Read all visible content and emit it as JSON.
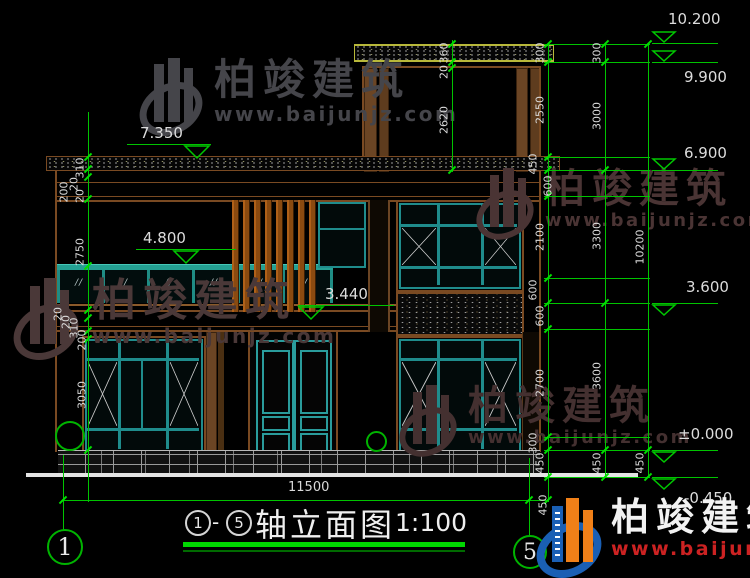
{
  "drawing": {
    "title": {
      "axis_start": "1",
      "dash": "-",
      "axis_end": "5",
      "name": "轴立面图",
      "scale": "1:100"
    },
    "axis_bubbles": {
      "left": "1",
      "right": "5"
    },
    "elevations": {
      "e7350": "7.350",
      "e4800": "4.800",
      "e3440": "3.440",
      "e10200": "10.200",
      "e9900": "9.900",
      "e6900": "6.900",
      "e3600": "3.600",
      "e0": "±0.000",
      "em450": "-0.450"
    },
    "dims": {
      "right_a": [
        "300",
        "2550",
        "450",
        "600",
        "2100",
        "600",
        "600",
        "2700",
        "300",
        "450"
      ],
      "right_b": [
        "300",
        "3000",
        "3300",
        "3600",
        "450"
      ],
      "right_c": [
        "10200",
        "450"
      ],
      "left": [
        "310",
        "200",
        "20",
        "20",
        "2750",
        "20",
        "20",
        "310",
        "200",
        "3050"
      ],
      "top": [
        "360",
        "20",
        "2620"
      ],
      "bottom_total": "11500",
      "bottom_right": "450"
    }
  },
  "watermark": {
    "brand": "柏竣建筑",
    "url": "www.baijunjz.com"
  },
  "logo": {
    "brand": "柏竣建筑",
    "url": "www.baijunjz.com"
  }
}
